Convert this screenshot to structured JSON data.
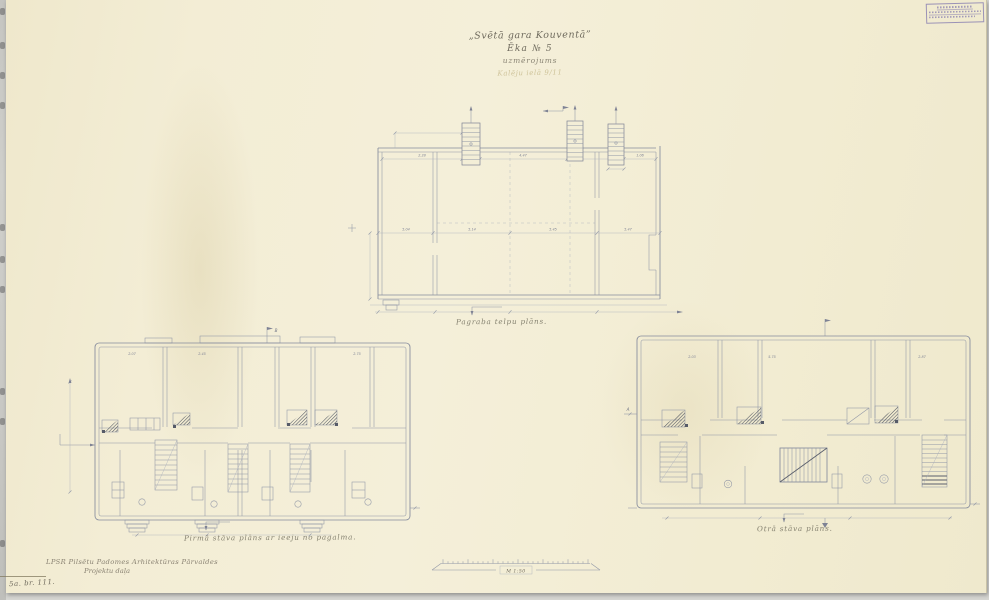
{
  "sheet": {
    "paper_color": "#f3eed7",
    "line_color": "#9096a6",
    "stamp_color": "#6a60a8"
  },
  "header": {
    "title": "„Svētā gara Kouventā”",
    "building": "Ēka № 5",
    "doc_type": "uzmērojums",
    "pencil_note": "Kalēju ielā 9/11"
  },
  "plans": {
    "basement": {
      "caption": "Pagraba telpu plāns."
    },
    "first_floor": {
      "caption": "Pirmā stāva plāns ar ieeju no pagalma."
    },
    "second_floor": {
      "caption": "Otrā stāva plāns."
    }
  },
  "dims": {
    "basement": [
      "5.04",
      "5.14",
      "5.45",
      "5.47"
    ],
    "basement_upper": [
      "2.28",
      "4.47",
      "1.06"
    ],
    "first_floor": [
      "2.07",
      "2.45",
      "2.75"
    ],
    "second_floor": [
      "2.03",
      "5.75",
      "2.87"
    ]
  },
  "markers": {
    "a": "A",
    "b": "B"
  },
  "footer": {
    "organization_line1": "LPSR Pilsētu Padomes Arhitektūras Pārvaldes",
    "organization_line2": "Projektu daļa",
    "scale": "M 1:50",
    "sheet_mark": "5a. br. 111."
  }
}
